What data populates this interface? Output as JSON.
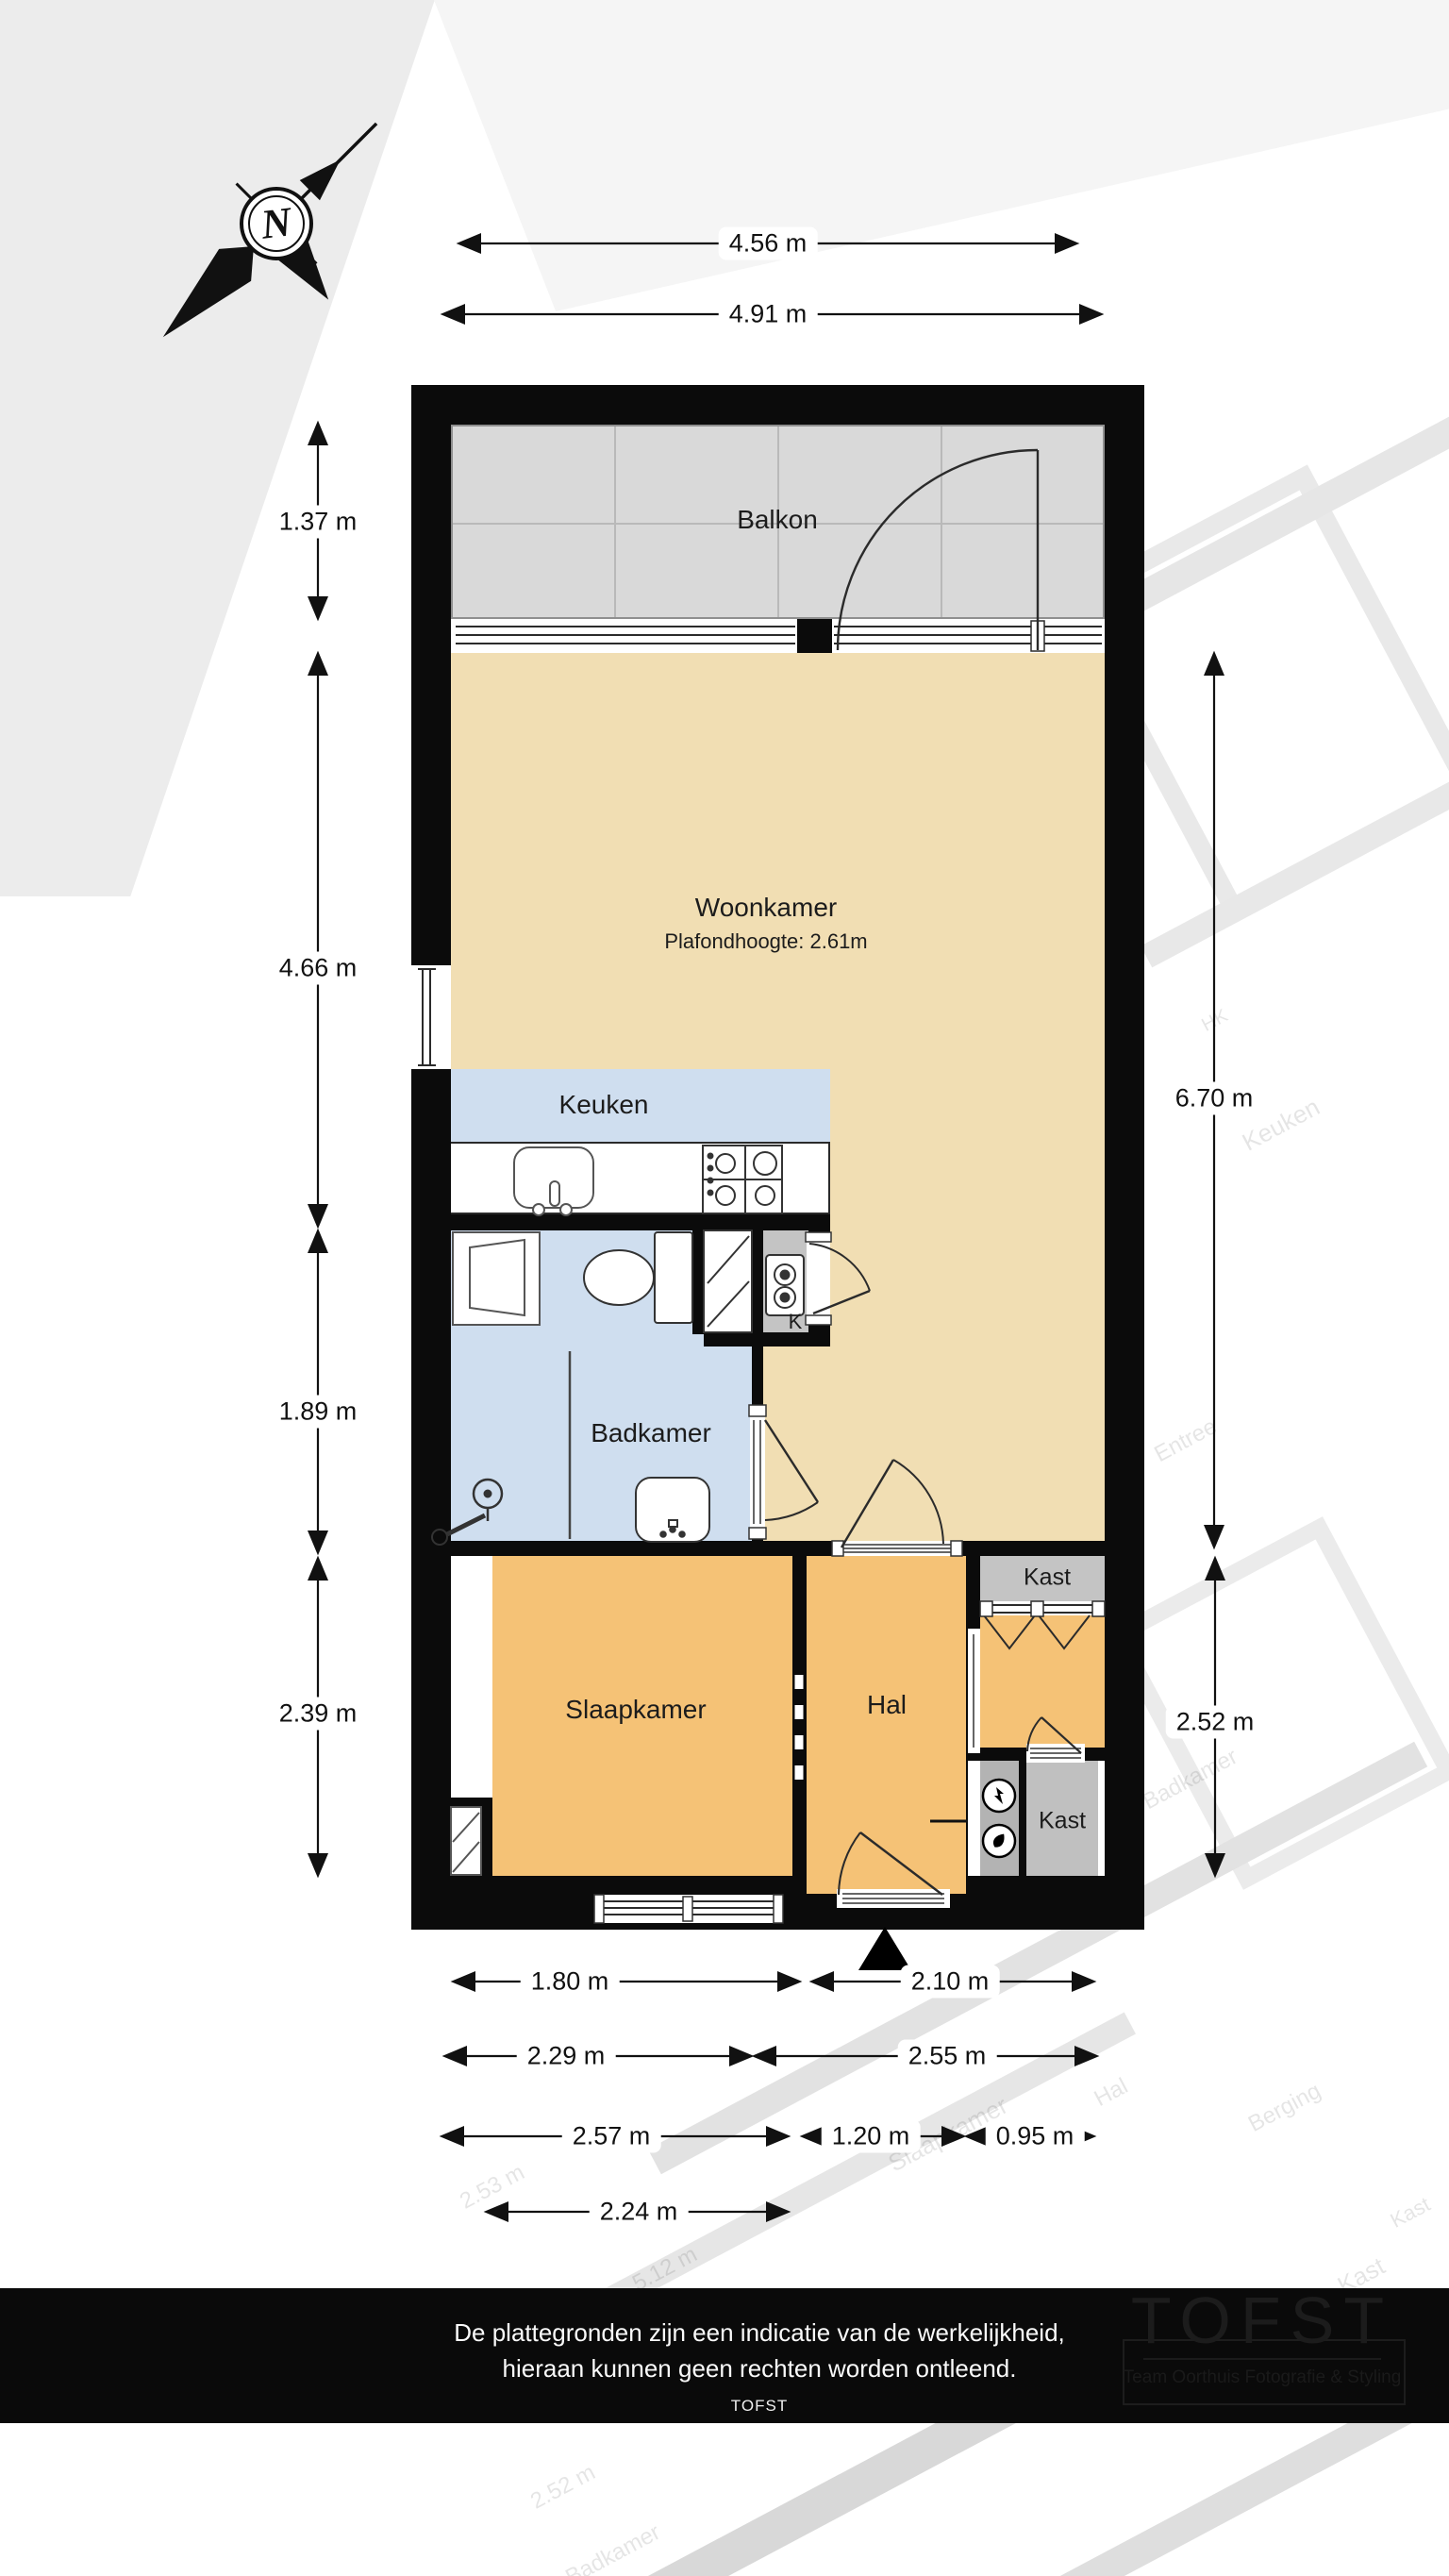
{
  "compass": {
    "label": "N"
  },
  "rooms": {
    "balkon": "Balkon",
    "woonkamer": "Woonkamer",
    "woonkamer_sub": "Plafondhoogte: 2.61m",
    "keuken": "Keuken",
    "badkamer": "Badkamer",
    "slaapkamer": "Slaapkamer",
    "hal": "Hal",
    "kast_top": "Kast",
    "kast_bottom": "Kast",
    "k_closet": "K"
  },
  "dimensions": {
    "top": [
      "4.56 m",
      "4.91 m"
    ],
    "left": [
      "1.37 m",
      "4.66 m",
      "1.89 m",
      "2.39 m"
    ],
    "right": [
      "6.70 m",
      "2.52 m"
    ],
    "bottom_row1": [
      "1.80 m",
      "2.10 m"
    ],
    "bottom_row2": [
      "2.29 m",
      "2.55 m"
    ],
    "bottom_row3": [
      "2.57 m",
      "1.20 m",
      "0.95 m"
    ],
    "bottom_row4": [
      "2.24 m"
    ]
  },
  "footer": {
    "line1": "De plattegronden zijn een indicatie van de werkelijkheid,",
    "line2": "hieraan kunnen geen rechten worden ontleend.",
    "line3": "TOFST"
  },
  "logo": {
    "title": "TOFST",
    "subtitle": "Team Oorthuis Fotografie & Styling"
  },
  "watermark": {
    "labels": [
      "Keuken",
      "HK",
      "HK",
      "Entree",
      "Badkamer",
      "Slaapkamer",
      "Hal",
      "Berging",
      "Kast",
      "Kast",
      "2.53 m",
      "5.12 m",
      "2.52 m",
      "Badkamer"
    ]
  },
  "colors": {
    "wall": "#0b0b0b",
    "woonkamer_floor": "#f1deb3",
    "hal_slaapkamer_floor": "#f5c276",
    "keuken_badkamer_floor": "#cfdeef",
    "balkon_floor": "#d9d9d9",
    "kast_floor": "#c4c4c4",
    "meterkast_floor": "#b3b3b3",
    "dimension_text": "#111111",
    "footer_background": "#0a0a0a",
    "footer_text": "#fafafa"
  }
}
